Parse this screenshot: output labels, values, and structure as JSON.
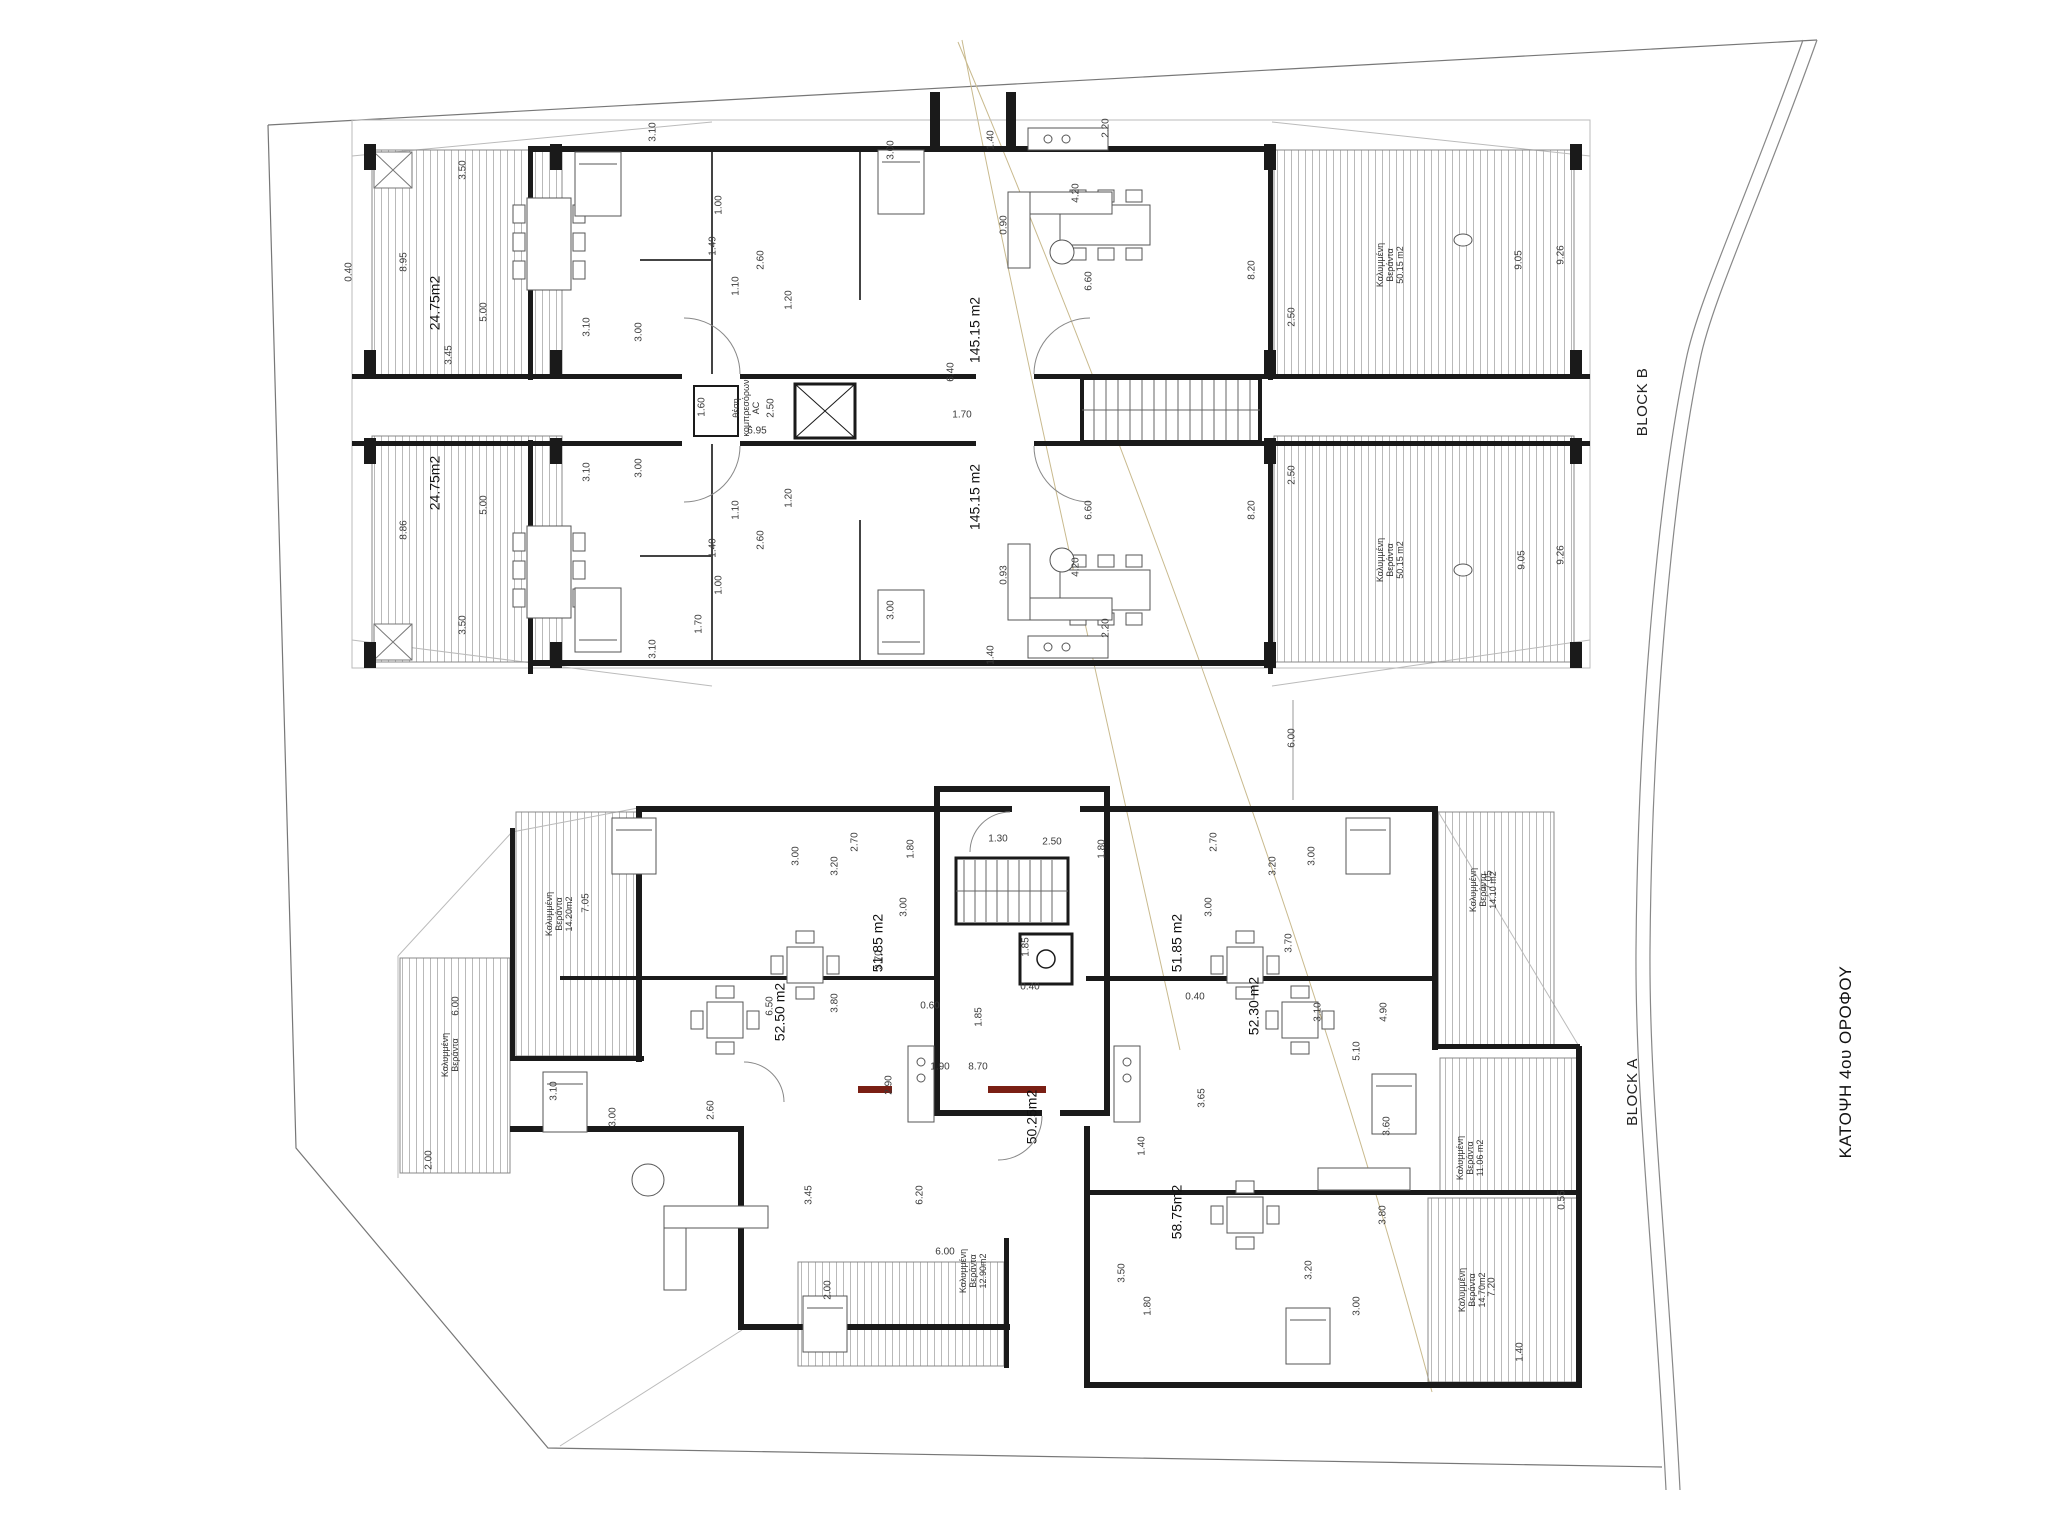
{
  "labels": {
    "sheet_title": {
      "text": "ΚΑΤΟΨΗ 4ου ΟΡΟΦΟΥ"
    },
    "block_b": {
      "text": "BLOCK B"
    },
    "block_a": {
      "text": "BLOCK A"
    }
  },
  "colors": {
    "wall": "#1a1a1a",
    "thin_line": "#8a8a8a",
    "hatch_line": "#b9b9b9",
    "site_line": "#777777",
    "road_line": "#888888",
    "survey_tan": "#c9ba8e",
    "accent_red": "#7a1f14",
    "text": "#222222"
  },
  "annotations": {
    "areas": [
      {
        "t": "145.15 m2",
        "x": 975,
        "y": 330
      },
      {
        "t": "145.15 m2",
        "x": 975,
        "y": 497
      },
      {
        "t": "24.75m2",
        "x": 435,
        "y": 303
      },
      {
        "t": "24.75m2",
        "x": 435,
        "y": 483
      },
      {
        "t": "51.85 m2",
        "x": 878,
        "y": 943
      },
      {
        "t": "51.85 m2",
        "x": 1177,
        "y": 943
      },
      {
        "t": "52.50 m2",
        "x": 780,
        "y": 1012
      },
      {
        "t": "52.30 m2",
        "x": 1254,
        "y": 1006
      },
      {
        "t": "50.25m2",
        "x": 1032,
        "y": 1117
      },
      {
        "t": "58.75m2",
        "x": 1177,
        "y": 1212
      }
    ],
    "verandas": [
      {
        "lines": [
          "Καλυμμένη",
          "Βεράντα",
          "50.15 m2"
        ],
        "x": 1390,
        "y": 265
      },
      {
        "lines": [
          "Καλυμμένη",
          "Βεράντα",
          "50.15 m2"
        ],
        "x": 1390,
        "y": 560
      },
      {
        "lines": [
          "Καλυμμένη",
          "Βεράντα",
          "14.20m2"
        ],
        "x": 559,
        "y": 914
      },
      {
        "lines": [
          "Καλυμμένη",
          "Βεράντα"
        ],
        "x": 450,
        "y": 1055
      },
      {
        "lines": [
          "Καλυμμένη",
          "Βεράντα",
          "12.90m2"
        ],
        "x": 973,
        "y": 1271
      },
      {
        "lines": [
          "Καλυμμένη",
          "Βεράντα",
          "14.10 m2"
        ],
        "x": 1483,
        "y": 890
      },
      {
        "lines": [
          "Καλυμμένη",
          "Βεράντα",
          "11.06 m2"
        ],
        "x": 1470,
        "y": 1158
      },
      {
        "lines": [
          "Καλυμμένη",
          "Βεράντα",
          "14.70m2"
        ],
        "x": 1472,
        "y": 1290
      }
    ],
    "notes": [
      {
        "lines": [
          "θέση",
          "κομπρεσόρων",
          "AC"
        ],
        "x": 746,
        "y": 408
      }
    ],
    "dims": [
      {
        "t": "0.40",
        "x": 350,
        "y": 272
      },
      {
        "t": "8.95",
        "x": 405,
        "y": 262
      },
      {
        "t": "5.00",
        "x": 485,
        "y": 312
      },
      {
        "t": "3.45",
        "x": 450,
        "y": 355
      },
      {
        "t": "3.50",
        "x": 464,
        "y": 170
      },
      {
        "t": "3.10",
        "x": 588,
        "y": 327
      },
      {
        "t": "3.00",
        "x": 640,
        "y": 332
      },
      {
        "t": "3.10",
        "x": 654,
        "y": 132
      },
      {
        "t": "3.00",
        "x": 892,
        "y": 150
      },
      {
        "t": "1.00",
        "x": 720,
        "y": 205
      },
      {
        "t": "1.49",
        "x": 714,
        "y": 246
      },
      {
        "t": "2.60",
        "x": 762,
        "y": 260
      },
      {
        "t": "1.10",
        "x": 737,
        "y": 286
      },
      {
        "t": "1.20",
        "x": 790,
        "y": 300
      },
      {
        "t": "1.60",
        "x": 703,
        "y": 407
      },
      {
        "t": "2.50",
        "x": 772,
        "y": 408
      },
      {
        "t": "6.95",
        "x": 757,
        "y": 432,
        "h": 1
      },
      {
        "t": "1.70",
        "x": 962,
        "y": 416,
        "h": 1
      },
      {
        "t": "6.40",
        "x": 952,
        "y": 372
      },
      {
        "t": "1.40",
        "x": 992,
        "y": 140
      },
      {
        "t": "2.20",
        "x": 1107,
        "y": 128
      },
      {
        "t": "4.20",
        "x": 1077,
        "y": 193
      },
      {
        "t": "0.90",
        "x": 1005,
        "y": 225
      },
      {
        "t": "6.60",
        "x": 1090,
        "y": 281
      },
      {
        "t": "8.20",
        "x": 1253,
        "y": 270
      },
      {
        "t": "2.50",
        "x": 1293,
        "y": 317
      },
      {
        "t": "9.05",
        "x": 1520,
        "y": 260
      },
      {
        "t": "9.26",
        "x": 1562,
        "y": 255
      },
      {
        "t": "8.86",
        "x": 405,
        "y": 530
      },
      {
        "t": "5.00",
        "x": 485,
        "y": 505
      },
      {
        "t": "3.50",
        "x": 464,
        "y": 625
      },
      {
        "t": "3.10",
        "x": 588,
        "y": 472
      },
      {
        "t": "3.00",
        "x": 640,
        "y": 468
      },
      {
        "t": "3.10",
        "x": 654,
        "y": 649
      },
      {
        "t": "3.00",
        "x": 892,
        "y": 610
      },
      {
        "t": "1.00",
        "x": 720,
        "y": 585
      },
      {
        "t": "1.40",
        "x": 714,
        "y": 548
      },
      {
        "t": "2.60",
        "x": 762,
        "y": 540
      },
      {
        "t": "1.10",
        "x": 737,
        "y": 510
      },
      {
        "t": "1.20",
        "x": 790,
        "y": 498
      },
      {
        "t": "1.70",
        "x": 700,
        "y": 624
      },
      {
        "t": "2.50",
        "x": 1293,
        "y": 475
      },
      {
        "t": "1.40",
        "x": 992,
        "y": 655
      },
      {
        "t": "2.20",
        "x": 1107,
        "y": 628
      },
      {
        "t": "4.20",
        "x": 1077,
        "y": 567
      },
      {
        "t": "0.93",
        "x": 1005,
        "y": 575
      },
      {
        "t": "6.60",
        "x": 1090,
        "y": 510
      },
      {
        "t": "8.20",
        "x": 1253,
        "y": 510
      },
      {
        "t": "9.05",
        "x": 1523,
        "y": 560
      },
      {
        "t": "9.26",
        "x": 1562,
        "y": 555
      },
      {
        "t": "6.00",
        "x": 1293,
        "y": 738
      },
      {
        "t": "1.30",
        "x": 998,
        "y": 840,
        "h": 1
      },
      {
        "t": "2.50",
        "x": 1052,
        "y": 843,
        "h": 1
      },
      {
        "t": "1.80",
        "x": 912,
        "y": 849
      },
      {
        "t": "1.80",
        "x": 1103,
        "y": 849
      },
      {
        "t": "2.70",
        "x": 856,
        "y": 842
      },
      {
        "t": "2.70",
        "x": 1215,
        "y": 842
      },
      {
        "t": "3.00",
        "x": 797,
        "y": 856
      },
      {
        "t": "3.00",
        "x": 1313,
        "y": 856
      },
      {
        "t": "3.20",
        "x": 836,
        "y": 866
      },
      {
        "t": "3.20",
        "x": 1274,
        "y": 866
      },
      {
        "t": "3.00",
        "x": 905,
        "y": 907
      },
      {
        "t": "3.00",
        "x": 1210,
        "y": 907
      },
      {
        "t": "1.85",
        "x": 1027,
        "y": 947
      },
      {
        "t": "1.85",
        "x": 980,
        "y": 1017
      },
      {
        "t": "0.60",
        "x": 930,
        "y": 1007,
        "h": 1
      },
      {
        "t": "7.05",
        "x": 587,
        "y": 903
      },
      {
        "t": "3.70",
        "x": 880,
        "y": 960
      },
      {
        "t": "3.70",
        "x": 1290,
        "y": 943
      },
      {
        "t": "6.00",
        "x": 457,
        "y": 1006
      },
      {
        "t": "6.50",
        "x": 771,
        "y": 1006
      },
      {
        "t": "3.80",
        "x": 836,
        "y": 1003
      },
      {
        "t": "3.10",
        "x": 555,
        "y": 1091
      },
      {
        "t": "3.00",
        "x": 614,
        "y": 1117
      },
      {
        "t": "2.60",
        "x": 712,
        "y": 1110
      },
      {
        "t": "2.90",
        "x": 890,
        "y": 1085
      },
      {
        "t": "1.90",
        "x": 940,
        "y": 1068,
        "h": 1
      },
      {
        "t": "8.70",
        "x": 978,
        "y": 1068,
        "h": 1
      },
      {
        "t": "3.45",
        "x": 810,
        "y": 1195
      },
      {
        "t": "6.20",
        "x": 921,
        "y": 1195
      },
      {
        "t": "1.40",
        "x": 1143,
        "y": 1146
      },
      {
        "t": "3.65",
        "x": 1203,
        "y": 1098
      },
      {
        "t": "0.40",
        "x": 1030,
        "y": 988,
        "h": 1
      },
      {
        "t": "0.40",
        "x": 1195,
        "y": 998,
        "h": 1
      },
      {
        "t": "3.10",
        "x": 1319,
        "y": 1012
      },
      {
        "t": "4.90",
        "x": 1385,
        "y": 1012
      },
      {
        "t": "5.10",
        "x": 1358,
        "y": 1051
      },
      {
        "t": "3.60",
        "x": 1388,
        "y": 1126
      },
      {
        "t": "3.80",
        "x": 1384,
        "y": 1215
      },
      {
        "t": "3.50",
        "x": 1123,
        "y": 1273
      },
      {
        "t": "3.20",
        "x": 1310,
        "y": 1270
      },
      {
        "t": "1.80",
        "x": 1149,
        "y": 1306
      },
      {
        "t": "3.00",
        "x": 1358,
        "y": 1306
      },
      {
        "t": "1.40",
        "x": 1521,
        "y": 1352
      },
      {
        "t": "0.55",
        "x": 1563,
        "y": 1200
      },
      {
        "t": "7.20",
        "x": 1493,
        "y": 1287
      },
      {
        "t": "7.05",
        "x": 1490,
        "y": 880
      },
      {
        "t": "6.00",
        "x": 945,
        "y": 1253,
        "h": 1
      },
      {
        "t": "2.00",
        "x": 829,
        "y": 1290
      },
      {
        "t": "2.00",
        "x": 430,
        "y": 1160
      }
    ]
  }
}
